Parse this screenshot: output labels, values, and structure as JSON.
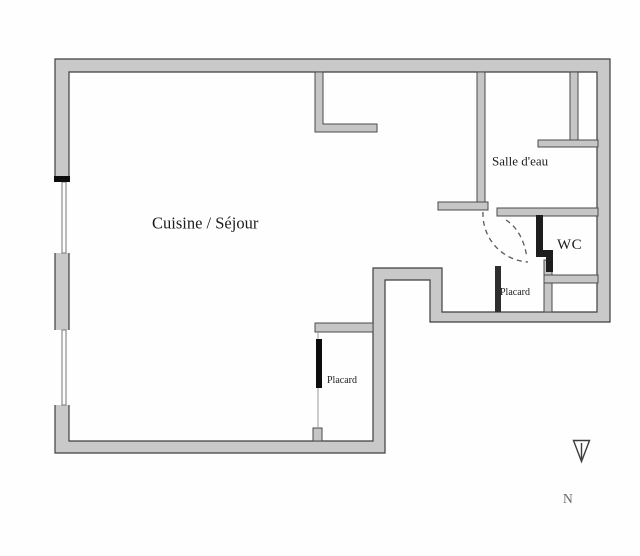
{
  "plan": {
    "title": "Apartment floor plan",
    "rooms": [
      {
        "id": "cuisine-sejour",
        "label": "Cuisine / Séjour"
      },
      {
        "id": "salle-deau",
        "label": "Salle d'eau"
      },
      {
        "id": "wc",
        "label": "WC"
      },
      {
        "id": "placard-entry",
        "label": "Placard"
      },
      {
        "id": "placard-bottom",
        "label": "Placard"
      }
    ],
    "compass": {
      "letter": "N",
      "direction": "down"
    },
    "colors": {
      "background": "#fefefe",
      "wall_fill": "#c9c9c9",
      "wall_outline": "#3f3f3f",
      "interior_wall_fill": "#c6c6c6",
      "dark_wall": "#1d1d1d",
      "door_leaf": "#0d0d0d",
      "window_line": "#777777",
      "arc_dash": "#5a5a5a",
      "label_text": "#1c1c1c"
    }
  }
}
